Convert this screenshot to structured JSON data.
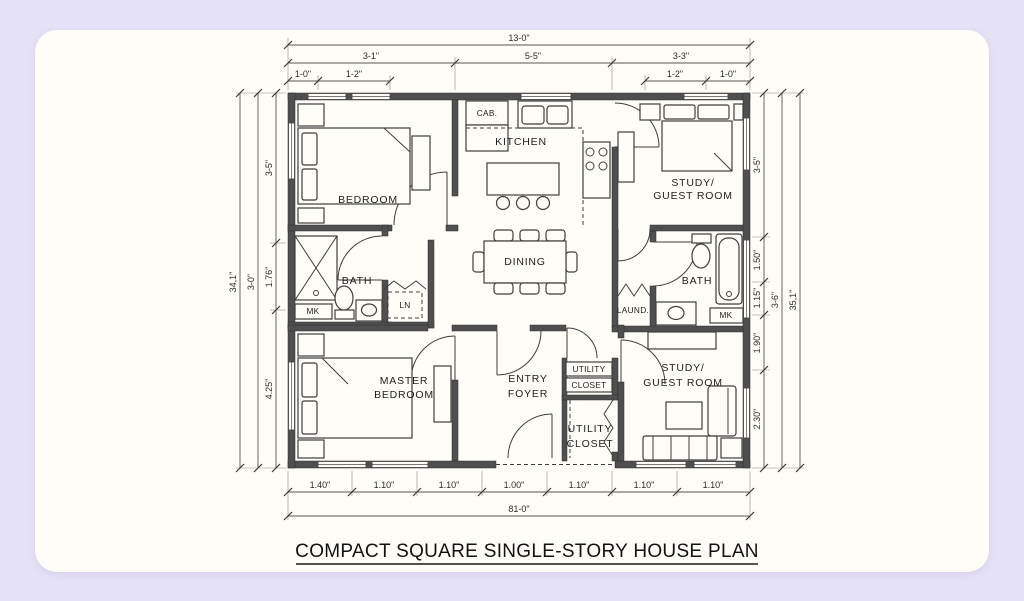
{
  "title": "COMPACT SQUARE SINGLE-STORY HOUSE PLAN",
  "colors": {
    "background": "#e6e2f6",
    "card": "#fffdf8",
    "walls": "#4f4f4f",
    "lines": "#3d3d3d",
    "text": "#1d1d1d"
  },
  "rooms": {
    "bedroom": "BEDROOM",
    "kitchen": "KITCHEN",
    "study_top_line1": "STUDY/",
    "study_top_line2": "GUEST ROOM",
    "bath_left": "BATH",
    "dining": "DINING",
    "bath_right": "BATH",
    "laundry": "LAUND.",
    "master_line1": "MASTER",
    "master_line2": "BEDROOM",
    "entry_line1": "ENTRY",
    "entry_line2": "FOYER",
    "utility_upper_line1": "UTILITY",
    "utility_upper_line2": "CLOSET",
    "utility_lower_line1": "UTILITY",
    "utility_lower_line2": "CLOSET",
    "study_bottom_line1": "STUDY/",
    "study_bottom_line2": "GUEST ROOM",
    "cab": "CAB.",
    "linen": "LN",
    "mk_left": "MK",
    "mk_right": "MK"
  },
  "dims": {
    "top_overall": "13-0\"",
    "top_row2": [
      "3-1\"",
      "5-5\"",
      "3-3\""
    ],
    "top_row3_left": [
      "1-0\"",
      "1-2\""
    ],
    "top_row3_right": [
      "1-2\"",
      "1-0\""
    ],
    "left_overall": "34,1\"",
    "left_mid": "3-0\"",
    "left_segments": [
      "3-5\"",
      "1.76\"",
      "4.25\""
    ],
    "right_segments": [
      "3-5\"",
      "1.50\"",
      "1.15\"",
      "1.90\"",
      "2.30\""
    ],
    "right_mid": "3-6\"",
    "right_overall": "35,1\"",
    "bottom_segments": [
      "1.40\"",
      "1.10\"",
      "1.10\"",
      "1.00\"",
      "1.10\"",
      "1.10\"",
      "1.10\""
    ],
    "bottom_overall": "81-0\""
  }
}
